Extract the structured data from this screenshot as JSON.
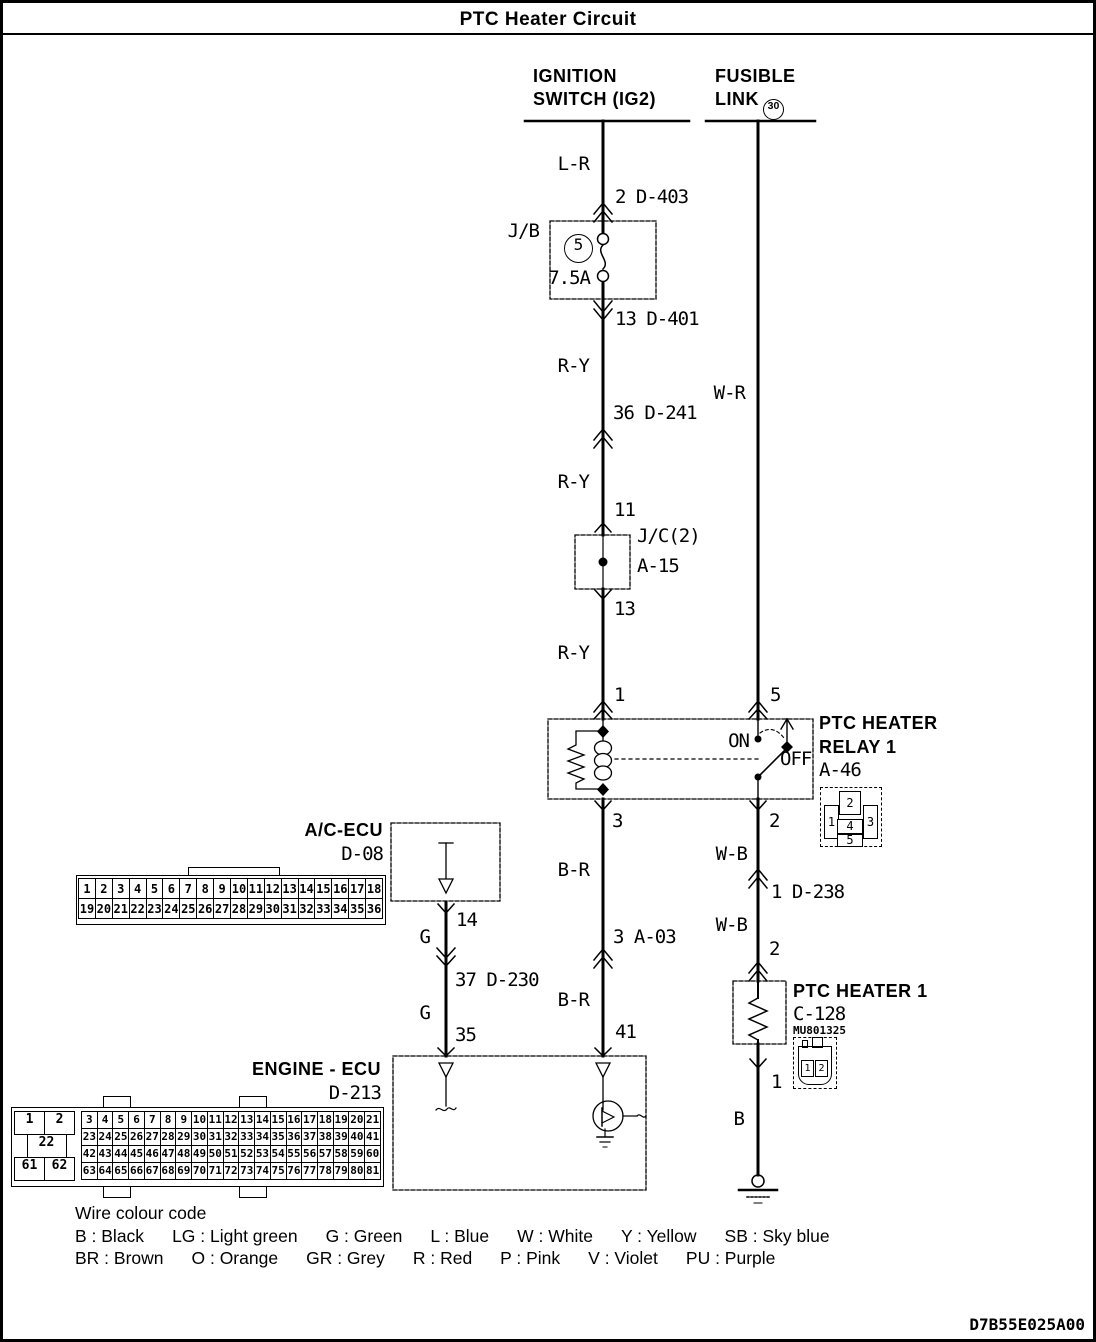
{
  "title": "PTC Heater Circuit",
  "doc_code": "D7B55E025A00",
  "colors": {
    "ink": "#000000",
    "paper": "#ffffff"
  },
  "ignition_switch": {
    "line1": "IGNITION",
    "line2": "SWITCH (IG2)"
  },
  "fusible_link": {
    "line1": "FUSIBLE",
    "line2": "LINK",
    "circle_no": "30"
  },
  "ignition_path": {
    "wire_lr": "L-R",
    "conn_d403": "2 D-403",
    "jb_label": "J/B",
    "jb_fuse_no": "5",
    "jb_fuse_rating": "7.5A",
    "conn_d401": "13 D-401",
    "wire_ry1": "R-Y",
    "conn_d241": "36 D-241",
    "wire_ry2": "R-Y",
    "jc_pin_in": "11",
    "jc_name": "J/C(2)",
    "jc_id": "A-15",
    "jc_pin_out": "13",
    "wire_ry3": "R-Y",
    "relay_pin": "1"
  },
  "fusible_path": {
    "wire_wr": "W-R",
    "relay_pin": "5"
  },
  "relay": {
    "name1": "PTC HEATER",
    "name2": "RELAY 1",
    "id": "A-46",
    "on": "ON",
    "off": "OFF",
    "pin_coil_out": "3",
    "pin_switch_out": "2",
    "connector_pins": [
      "1",
      "2",
      "3",
      "4",
      "5"
    ]
  },
  "coil_output": {
    "wire_br1": "B-R",
    "conn_a03": "3 A-03",
    "wire_br2": "B-R",
    "ecu_pin": "41"
  },
  "switch_output": {
    "wire_wb1": "W-B",
    "conn_d238": "1 D-238",
    "wire_wb2": "W-B",
    "heater_pin_in": "2",
    "heater_pin_out": "1",
    "wire_b": "B"
  },
  "ac_ecu": {
    "name": "A/C-ECU",
    "id": "D-08",
    "pin_out": "14",
    "wire_g1": "G",
    "conn_d230": "37 D-230",
    "wire_g2": "G",
    "ecu_pin": "35",
    "connector_row1": [
      "1",
      "2",
      "3",
      "4",
      "5",
      "6",
      "7",
      "8",
      "9",
      "10",
      "11",
      "12",
      "13",
      "14",
      "15",
      "16",
      "17",
      "18"
    ],
    "connector_row2": [
      "19",
      "20",
      "21",
      "22",
      "23",
      "24",
      "25",
      "26",
      "27",
      "28",
      "29",
      "30",
      "31",
      "32",
      "33",
      "34",
      "35",
      "36"
    ]
  },
  "ptc_heater": {
    "name": "PTC HEATER 1",
    "id": "C-128",
    "part_no": "MU801325",
    "connector_pins": [
      "1",
      "2"
    ]
  },
  "engine_ecu": {
    "name": "ENGINE - ECU",
    "id": "D-213",
    "connector_left": [
      [
        "1",
        "2"
      ],
      [
        "22"
      ],
      [
        "61",
        "62"
      ]
    ],
    "connector_rows": [
      [
        "3",
        "4",
        "5",
        "6",
        "7",
        "8",
        "9",
        "10",
        "11",
        "12",
        "13",
        "14",
        "15",
        "16",
        "17",
        "18",
        "19",
        "20",
        "21"
      ],
      [
        "23",
        "24",
        "25",
        "26",
        "27",
        "28",
        "29",
        "30",
        "31",
        "32",
        "33",
        "34",
        "35",
        "36",
        "37",
        "38",
        "39",
        "40",
        "41"
      ],
      [
        "42",
        "43",
        "44",
        "45",
        "46",
        "47",
        "48",
        "49",
        "50",
        "51",
        "52",
        "53",
        "54",
        "55",
        "56",
        "57",
        "58",
        "59",
        "60"
      ],
      [
        "63",
        "64",
        "65",
        "66",
        "67",
        "68",
        "69",
        "70",
        "71",
        "72",
        "73",
        "74",
        "75",
        "76",
        "77",
        "78",
        "79",
        "80",
        "81"
      ]
    ]
  },
  "legend": {
    "heading": "Wire colour code",
    "row1": [
      "B : Black",
      "LG : Light green",
      "G : Green",
      "L : Blue",
      "W : White",
      "Y : Yellow",
      "SB : Sky blue"
    ],
    "row2": [
      "BR : Brown",
      "O : Orange",
      "GR : Grey",
      "R : Red",
      "P : Pink",
      "V : Violet",
      "PU : Purple"
    ]
  }
}
